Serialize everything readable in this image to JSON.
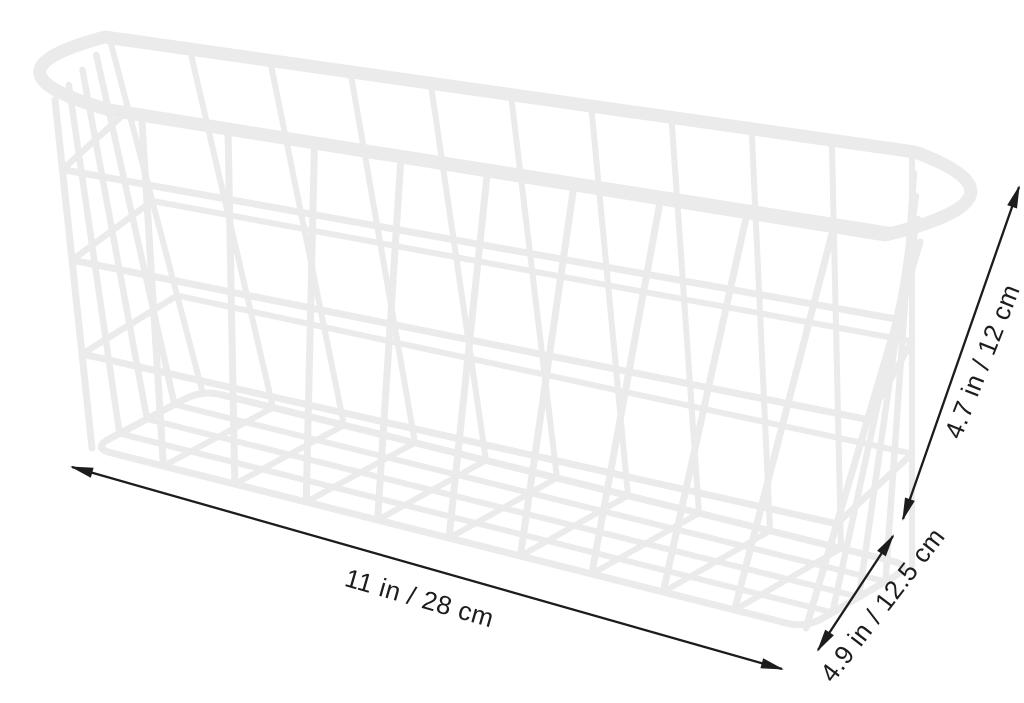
{
  "figure": {
    "subject": "white-wire-storage-basket",
    "background_color": "#ffffff",
    "basket_color": "#ebebeb",
    "dimension_line_color": "#1c1c1c",
    "dimensions": {
      "length": {
        "label": "11 in / 28 cm",
        "inches": 11,
        "cm": 28
      },
      "height": {
        "label": "4.7 in / 12 cm",
        "inches": 4.7,
        "cm": 12
      },
      "depth": {
        "label": "4.9 in / 12.5 cm",
        "inches": 4.9,
        "cm": 12.5
      }
    }
  }
}
